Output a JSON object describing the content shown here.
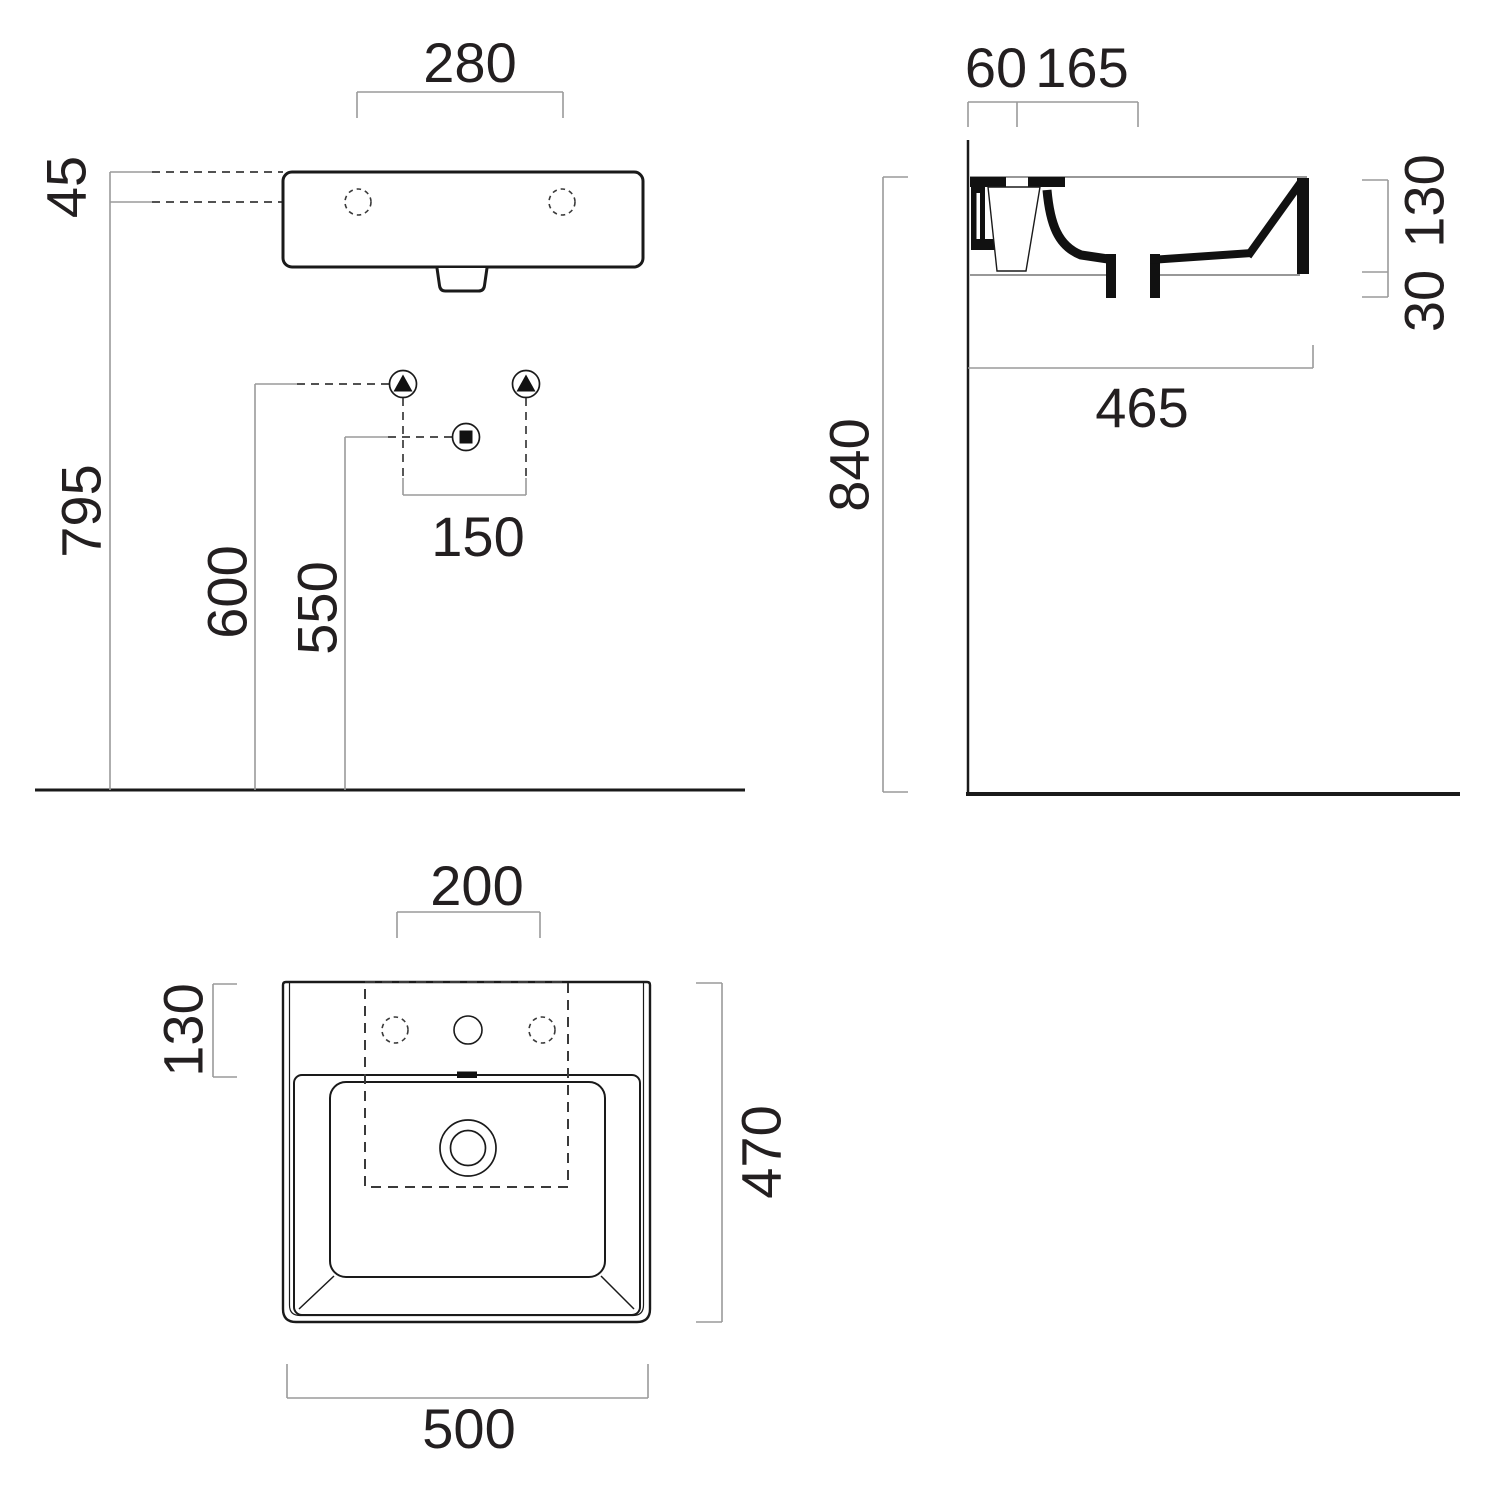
{
  "drawing": {
    "type": "technical-dimension-drawing",
    "subject": "wall-mounted rectangular washbasin shown in three orthographic views",
    "colors": {
      "outline": "#1a1a1a",
      "dimension_line": "#9a9a9a",
      "text": "#231f20",
      "background": "#ffffff"
    },
    "symbols": {
      "wall_fixing": "triangle-in-circle",
      "waste_outlet": "square-in-circle"
    },
    "views": {
      "front": {
        "name": "front elevation",
        "dimensions": {
          "hole_spacing": "280",
          "rim_to_holes": "45",
          "rim_height": "795",
          "fixing_height": "600",
          "waste_height": "550",
          "fixing_spacing": "150"
        }
      },
      "side": {
        "name": "side section",
        "dimensions": {
          "wall_to_hole": "60",
          "hole_to_waste": "165",
          "body_height": "130",
          "waste_stub": "30",
          "depth": "465",
          "mount_height": "840"
        }
      },
      "plan": {
        "name": "plan view",
        "dimensions": {
          "hole_group_width": "200",
          "deck_depth": "130",
          "overall_depth": "470",
          "overall_width": "500"
        }
      }
    }
  }
}
